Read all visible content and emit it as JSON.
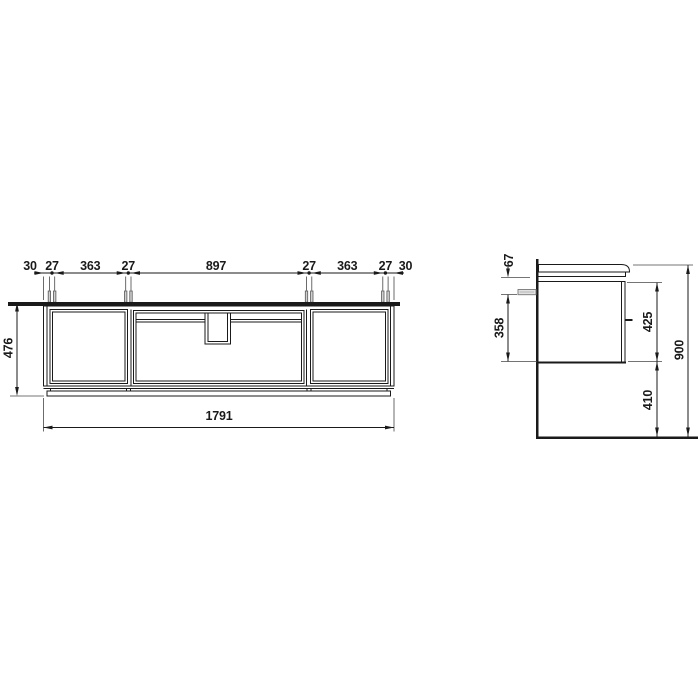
{
  "front": {
    "dims": [
      "30",
      "27",
      "363",
      "27",
      "897",
      "27",
      "363",
      "27",
      "30"
    ],
    "height": "476",
    "width": "1791"
  },
  "side": {
    "dim_67": "67",
    "dim_358": "358",
    "dim_425": "425",
    "dim_410": "410",
    "dim_900": "900"
  },
  "colors": {
    "line": "#1a1a1a",
    "background": "#ffffff",
    "anchor_fill": "#d0d0d0"
  }
}
